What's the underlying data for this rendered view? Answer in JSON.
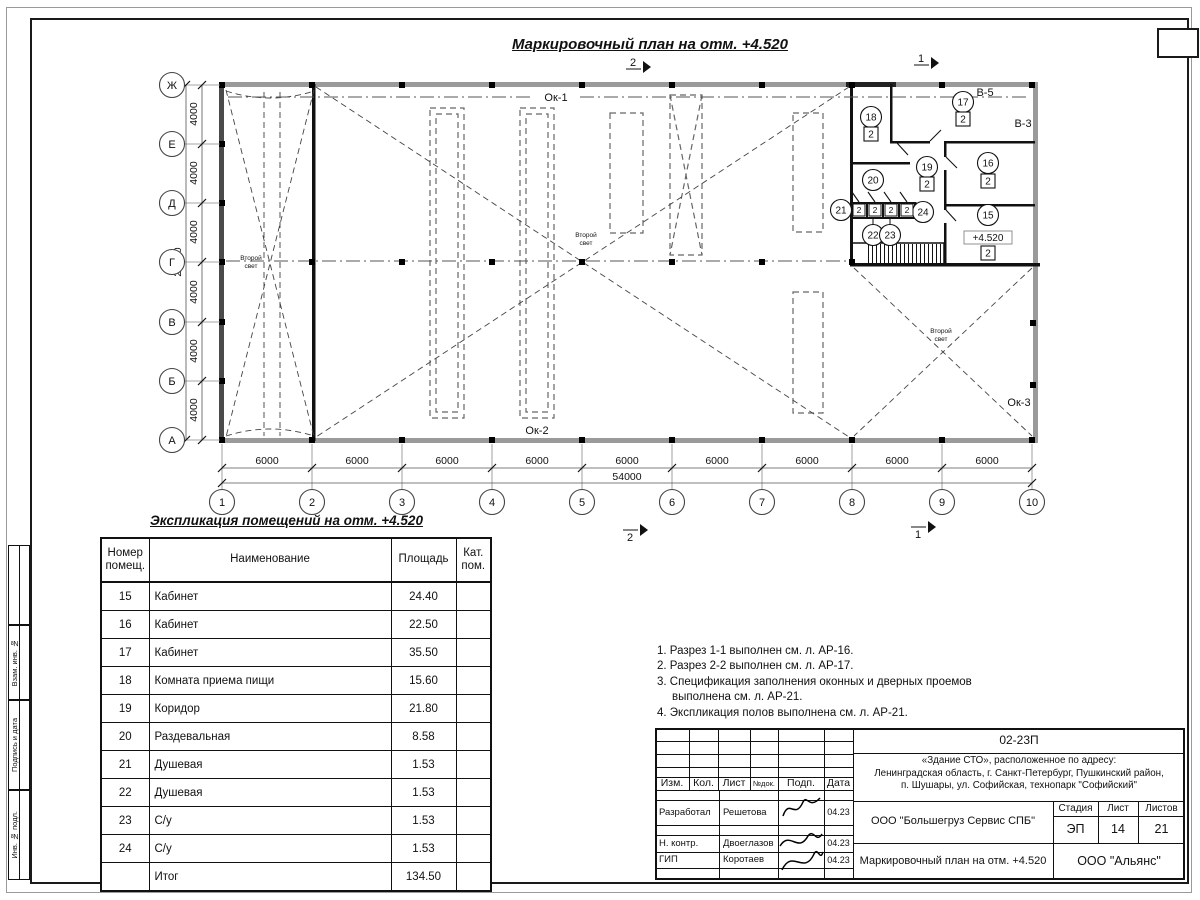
{
  "plan": {
    "title": "Маркировочный план на отм. +4.520",
    "second_light_line1": "Второй",
    "second_light_line2": "свет",
    "window_labels": {
      "ok1": "Ок-1",
      "ok2": "Ок-2",
      "ok3": "Ок-3",
      "v5": "В-5",
      "v3": "В-3"
    },
    "elevation_mark": "+4.520",
    "axes_letters": [
      "Ж",
      "Е",
      "Д",
      "Г",
      "В",
      "Б",
      "А"
    ],
    "axes_numbers": [
      "1",
      "2",
      "3",
      "4",
      "5",
      "6",
      "7",
      "8",
      "9",
      "10"
    ],
    "dims_bottom": [
      "6000",
      "6000",
      "6000",
      "6000",
      "6000",
      "6000",
      "6000",
      "6000",
      "6000"
    ],
    "dim_total_bottom": "54000",
    "dims_left": [
      "4000",
      "4000",
      "4000",
      "4000",
      "4000",
      "4000"
    ],
    "dim_total_left": "24000",
    "section_mark_1": "1",
    "section_mark_2": "2",
    "markers": {
      "m15": {
        "num": "15",
        "door": "2"
      },
      "m16": {
        "num": "16",
        "door": "2"
      },
      "m17": {
        "num": "17",
        "door": "2"
      },
      "m18": {
        "num": "18",
        "door": "2"
      },
      "m19": {
        "num": "19",
        "door": "2"
      },
      "m20": {
        "num": "20"
      },
      "m21": {
        "num": "21"
      },
      "m22": {
        "num": "22"
      },
      "m23": {
        "num": "23"
      },
      "m24": {
        "num": "24"
      }
    },
    "cell_door_marks": [
      "2",
      "2",
      "2",
      "2"
    ]
  },
  "explication": {
    "title": "Экспликация помещений на отм. +4.520",
    "headers": {
      "num": "Номер помещ.",
      "name": "Наименование",
      "area": "Площадь",
      "cat": "Кат. пом."
    },
    "rows": [
      {
        "num": "15",
        "name": "Кабинет",
        "area": "24.40",
        "cat": ""
      },
      {
        "num": "16",
        "name": "Кабинет",
        "area": "22.50",
        "cat": ""
      },
      {
        "num": "17",
        "name": "Кабинет",
        "area": "35.50",
        "cat": ""
      },
      {
        "num": "18",
        "name": "Комната приема пищи",
        "area": "15.60",
        "cat": ""
      },
      {
        "num": "19",
        "name": "Коридор",
        "area": "21.80",
        "cat": ""
      },
      {
        "num": "20",
        "name": "Раздевальная",
        "area": "8.58",
        "cat": ""
      },
      {
        "num": "21",
        "name": "Душевая",
        "area": "1.53",
        "cat": ""
      },
      {
        "num": "22",
        "name": "Душевая",
        "area": "1.53",
        "cat": ""
      },
      {
        "num": "23",
        "name": "С/у",
        "area": "1.53",
        "cat": ""
      },
      {
        "num": "24",
        "name": "С/у",
        "area": "1.53",
        "cat": ""
      }
    ],
    "total": {
      "label": "Итог",
      "value": "134.50"
    }
  },
  "notes": {
    "items": [
      "1. Разрез 1-1 выполнен см. л. АР-16.",
      "2. Разрез 2-2 выполнен см. л. АР-17.",
      "3. Спецификация заполнения оконных и дверных проемов выполнена см. л. АР-21.",
      "4. Экспликация полов выполнена см. л. АР-21."
    ]
  },
  "titleblock": {
    "doc_number": "02-23П",
    "address_line1": "«Здание СТО», расположенное по адресу:",
    "address_line2": "Ленинградская область, г. Санкт-Петербург, Пушкинский район,",
    "address_line3": "п. Шушары, ул. Софийская, технопарк \"Софийский\"",
    "headers": {
      "izm": "Изм.",
      "kol": "Кол.",
      "list": "Лист",
      "ndok": "№док.",
      "podp": "Подп.",
      "data": "Дата"
    },
    "roles": [
      {
        "role": "Разработал",
        "name": "Решетова",
        "date": "04.23"
      },
      {
        "role": "Н. контр.",
        "name": "Двоеглазов",
        "date": "04.23"
      },
      {
        "role": "ГИП",
        "name": "Коротаев",
        "date": "04.23"
      }
    ],
    "company": "ООО \"Большегруз Сервис СПБ\"",
    "stage_header": "Стадия",
    "sheet_header": "Лист",
    "sheets_header": "Листов",
    "stage": "ЭП",
    "sheet": "14",
    "sheets": "21",
    "doc_title": "Маркировочный план на отм. +4.520",
    "org": "ООО \"Альянс\""
  },
  "side_stamp": {
    "labels": [
      "Взам. инв. №",
      "Подпись и дата",
      "Инв. № подл."
    ]
  }
}
